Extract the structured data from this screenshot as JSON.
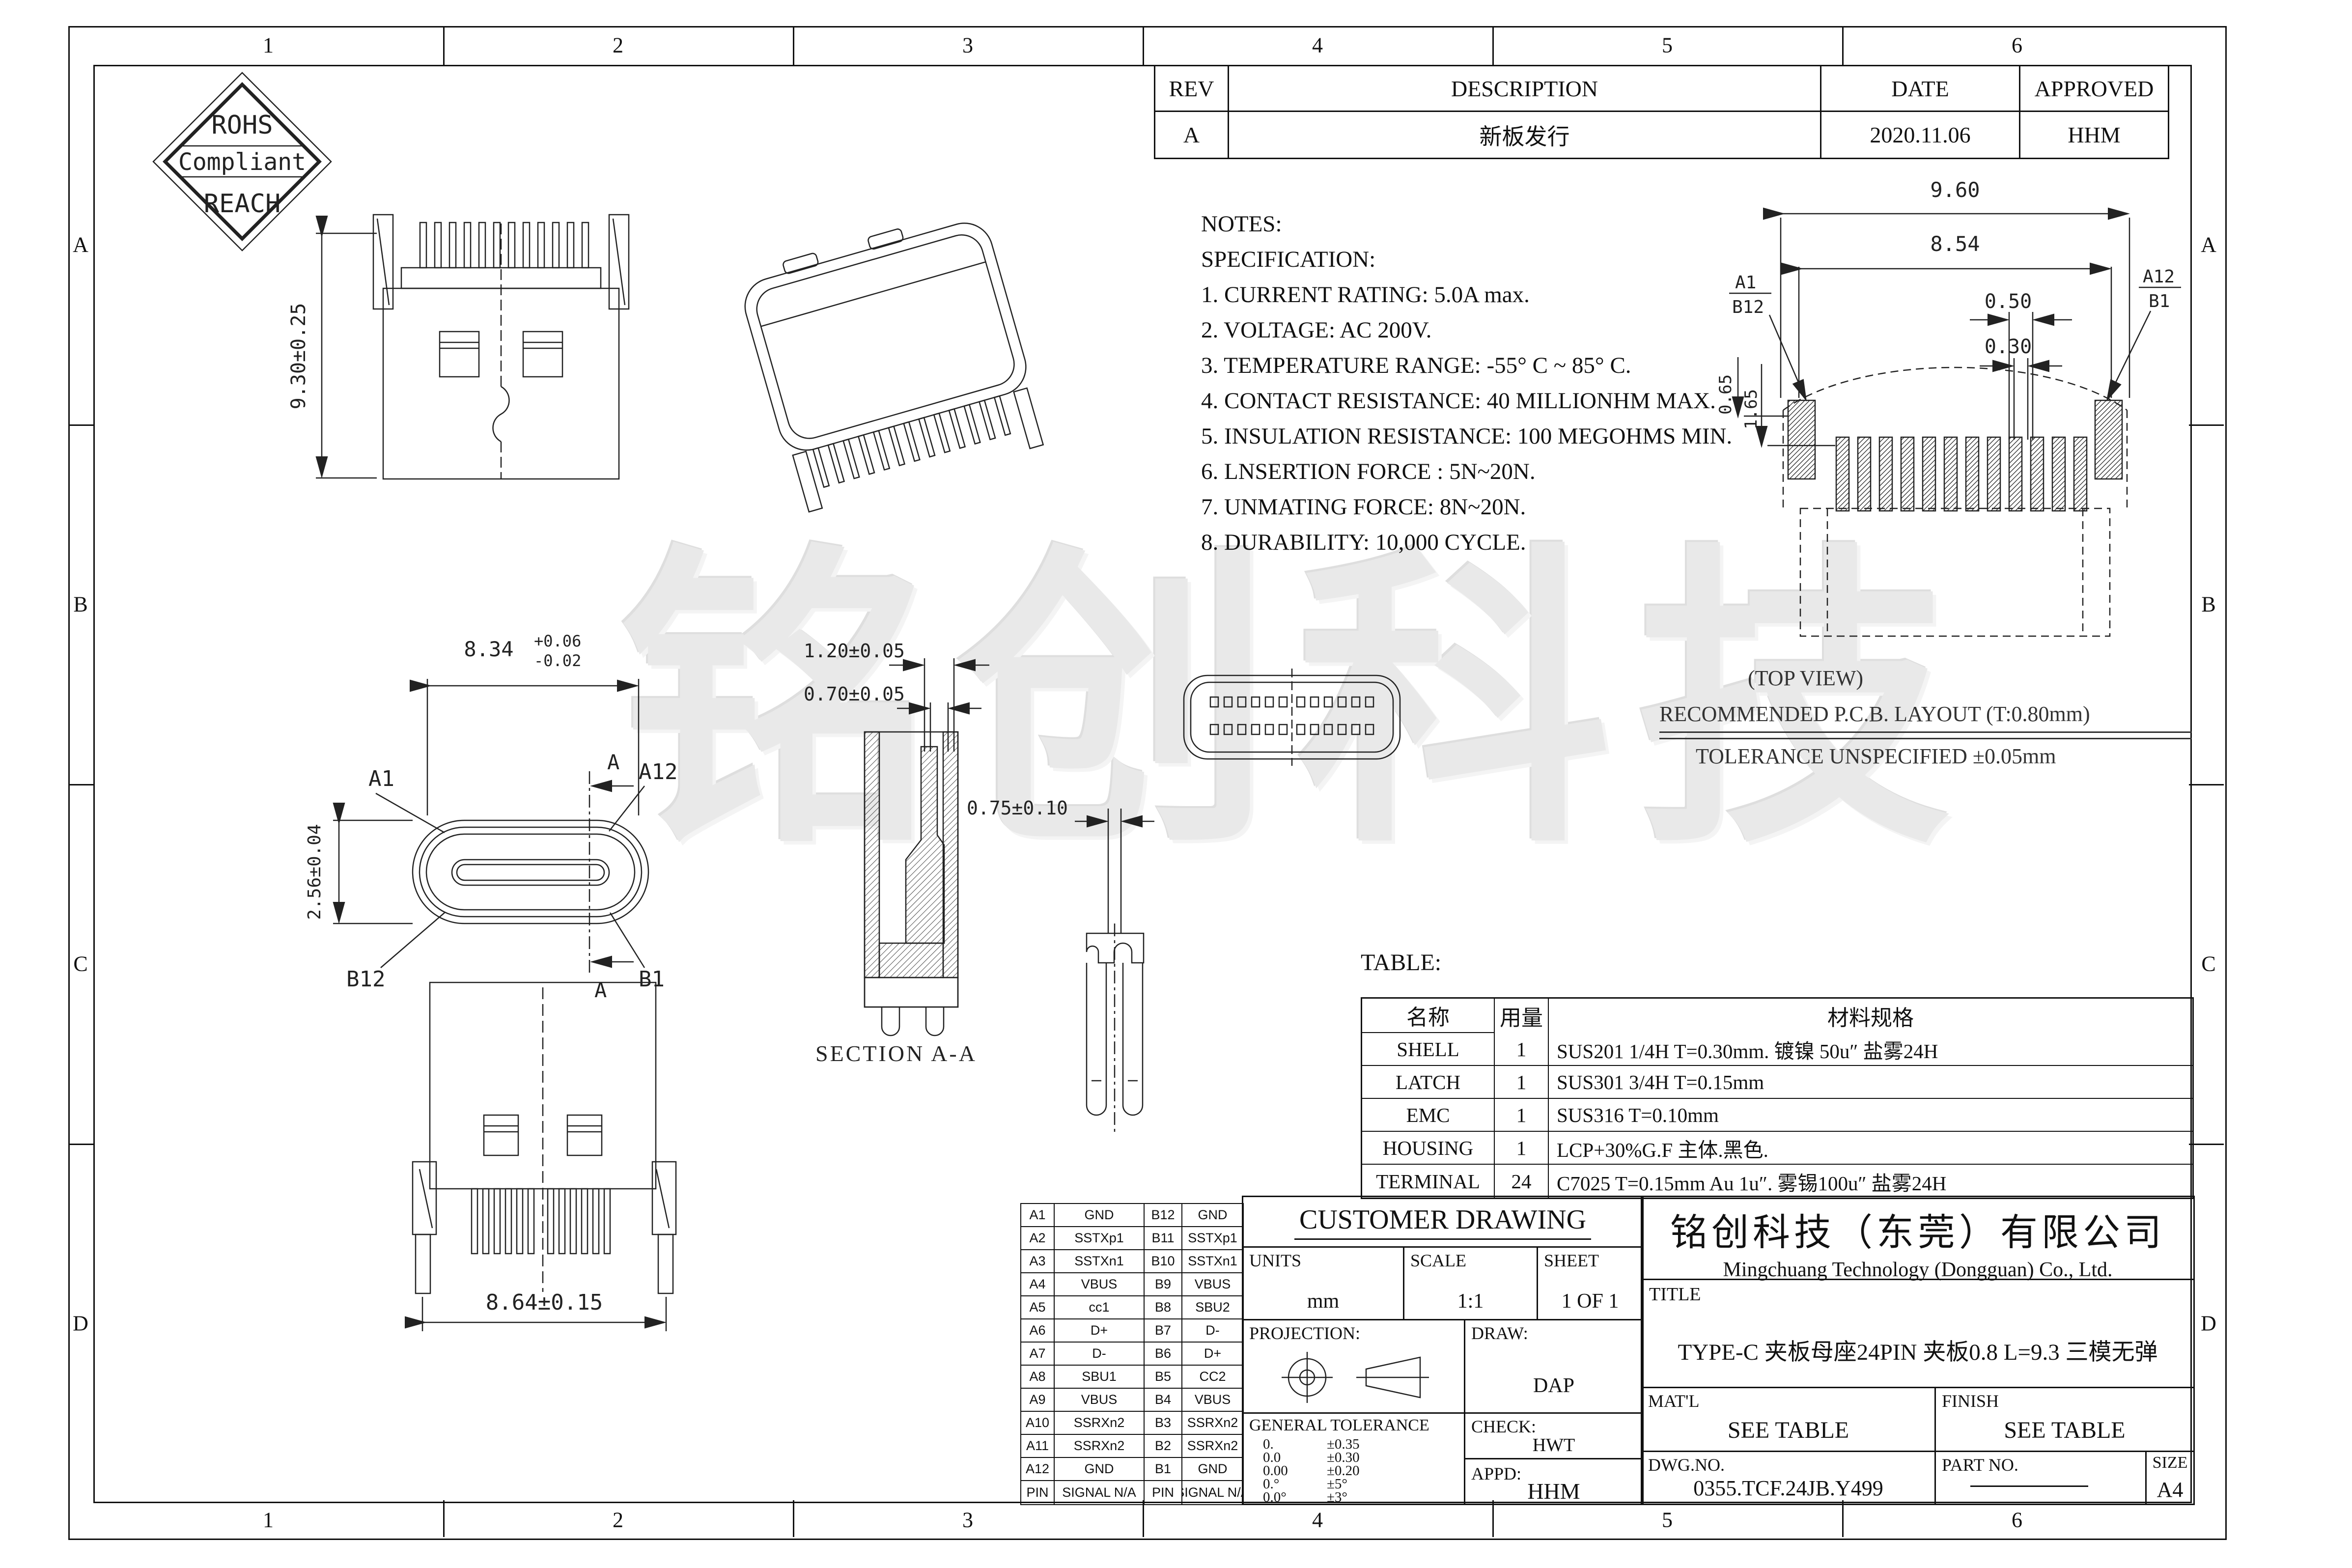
{
  "zones": {
    "columns": [
      "1",
      "2",
      "3",
      "4",
      "5",
      "6"
    ],
    "rows": [
      "A",
      "B",
      "C",
      "D"
    ]
  },
  "badge": {
    "line1": "ROHS",
    "line2": "Compliant",
    "line3": "REACH"
  },
  "revision": {
    "headers": [
      "REV",
      "DESCRIPTION",
      "DATE",
      "APPROVED"
    ],
    "row": [
      "A",
      "新板发行",
      "2020.11.06",
      "HHM"
    ]
  },
  "notes": {
    "title": "NOTES:",
    "subtitle": "SPECIFICATION:",
    "items": [
      "1. CURRENT RATING: 5.0A max.",
      "2. VOLTAGE: AC 200V.",
      "3. TEMPERATURE RANGE: -55° C ~ 85° C.",
      "4. CONTACT RESISTANCE: 40 MILLIONHM MAX.",
      "5. INSULATION RESISTANCE: 100 MEGOHMS MIN.",
      "6. LNSERTION FORCE : 5N~20N.",
      "7. UNMATING FORCE: 8N~20N.",
      "8. DURABILITY:  10,000 CYCLE."
    ]
  },
  "pcb": {
    "top_view_label": "(TOP VIEW)",
    "title": "RECOMMENDED  P.C.B. LAYOUT (T:0.80mm)",
    "tolerance_note": "TOLERANCE UNSPECIFIED ±0.05mm",
    "dim_width": "9.60",
    "dim_inner": "8.54",
    "dim_pitch": "0.50",
    "dim_pad": "0.30",
    "dim_row_offset": "0.65",
    "dim_depth": "1.65",
    "label_left_top": "A1",
    "label_left_bottom": "B12",
    "label_right_top": "A12",
    "label_right_bottom": "B1"
  },
  "views": {
    "front": {
      "dim_height": "9.30±0.25"
    },
    "mating": {
      "dim_width_base": "8.34",
      "dim_width_plus": "+0.06",
      "dim_width_minus": "-0.02",
      "dim_height": "2.56±0.04",
      "label_a1": "A1",
      "label_a12": "A12",
      "label_b12": "B12",
      "label_b1": "B1",
      "section_letter": "A"
    },
    "section": {
      "label": "SECTION A-A",
      "dim1": "1.20±0.05",
      "dim2": "0.70±0.05"
    },
    "terminal": {
      "dim": "0.75±0.10"
    },
    "rear": {
      "dim_width": "8.64±0.15"
    }
  },
  "materials": {
    "label": "TABLE:",
    "headers": [
      "名称",
      "用量",
      "材料规格"
    ],
    "rows": [
      [
        "SHELL",
        "1",
        "SUS201 1/4H T=0.30mm. 镀镍 50u″ 盐雾24H"
      ],
      [
        "LATCH",
        "1",
        "SUS301 3/4H T=0.15mm"
      ],
      [
        "EMC",
        "1",
        "SUS316  T=0.10mm"
      ],
      [
        "HOUSING",
        "1",
        "LCP+30%G.F 主体.黑色."
      ],
      [
        "TERMINAL",
        "24",
        "C7025  T=0.15mm  Au 1u″.  雾锡100u″ 盐雾24H"
      ]
    ]
  },
  "pins": {
    "rows": [
      [
        "A1",
        "GND",
        "B12",
        "GND"
      ],
      [
        "A2",
        "SSTXp1",
        "B11",
        "SSTXp1"
      ],
      [
        "A3",
        "SSTXn1",
        "B10",
        "SSTXn1"
      ],
      [
        "A4",
        "VBUS",
        "B9",
        "VBUS"
      ],
      [
        "A5",
        "cc1",
        "B8",
        "SBU2"
      ],
      [
        "A6",
        "D+",
        "B7",
        "D-"
      ],
      [
        "A7",
        "D-",
        "B6",
        "D+"
      ],
      [
        "A8",
        "SBU1",
        "B5",
        "CC2"
      ],
      [
        "A9",
        "VBUS",
        "B4",
        "VBUS"
      ],
      [
        "A10",
        "SSRXn2",
        "B3",
        "SSRXn2"
      ],
      [
        "A11",
        "SSRXn2",
        "B2",
        "SSRXn2"
      ],
      [
        "A12",
        "GND",
        "B1",
        "GND"
      ],
      [
        "PIN",
        "SIGNAL N/A",
        "PIN",
        "SIGNAL N/A"
      ]
    ]
  },
  "customer": {
    "title": "CUSTOMER DRAWING",
    "units_label": "UNITS",
    "units_value": "mm",
    "scale_label": "SCALE",
    "scale_value": "1:1",
    "sheet_label": "SHEET",
    "sheet_value": "1 OF 1",
    "projection_label": "PROJECTION:",
    "draw_label": "DRAW:",
    "draw_value": "DAP",
    "tolerance_label": "GENERAL TOLERANCE",
    "tolerances": [
      [
        "0.",
        "±0.35"
      ],
      [
        "0.0",
        "±0.30"
      ],
      [
        "0.00",
        "±0.20"
      ],
      [
        "0.°",
        "±5°"
      ],
      [
        "0.0°",
        "±3°"
      ]
    ],
    "check_label": "CHECK:",
    "check_value": "HWT",
    "appd_label": "APPD:",
    "appd_value": "HHM"
  },
  "titleblock": {
    "company_cn": "铭创科技（东莞）有限公司",
    "company_en": "Mingchuang Technology (Dongguan) Co., Ltd.",
    "title_label": "TITLE",
    "title_value": "TYPE-C 夹板母座24PIN 夹板0.8 L=9.3 三模无弹",
    "matl_label": "MAT'L",
    "matl_value": "SEE TABLE",
    "finish_label": "FINISH",
    "finish_value": "SEE TABLE",
    "dwg_label": "DWG.NO.",
    "dwg_value": "0355.TCF.24JB.Y499",
    "part_label": "PART NO.",
    "size_label": "SIZE",
    "size_value": "A4"
  },
  "watermark": "铭创科技"
}
